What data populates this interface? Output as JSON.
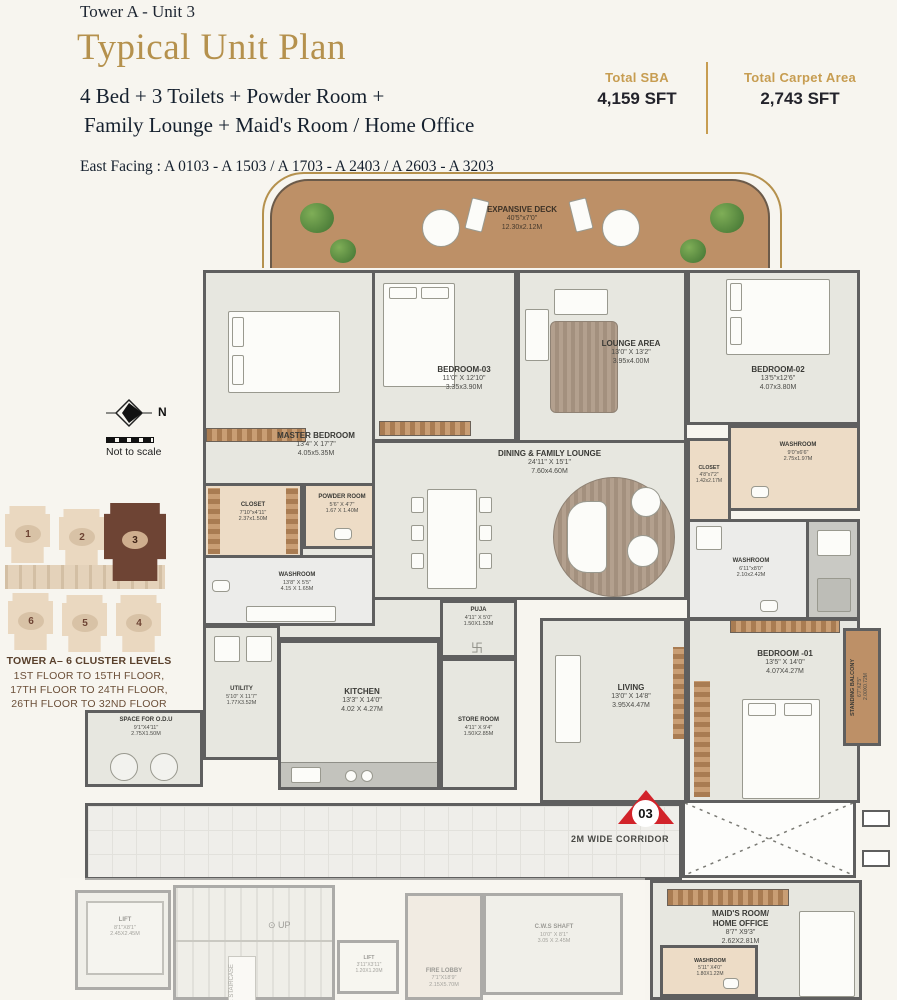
{
  "header": {
    "tower": "Tower A - Unit 3",
    "title": "Typical Unit Plan",
    "subtitle_line1": "4 Bed + 3 Toilets + Powder Room +",
    "subtitle_line2": "Family Lounge + Maid's Room / Home Office",
    "facing": "East Facing : A 0103  - A 1503 / A 1703 - A 2403 / A 2603 - A 3203",
    "stats": [
      {
        "label": "Total SBA",
        "value": "4,159 SFT"
      },
      {
        "label": "Total Carpet Area",
        "value": "2,743 SFT"
      }
    ]
  },
  "compass": {
    "north": "N",
    "note": "Not to scale"
  },
  "key_plan": {
    "title": "TOWER A– 6 CLUSTER LEVELS",
    "floors": [
      "1ST FLOOR TO 15TH FLOOR,",
      "17TH FLOOR TO 24TH FLOOR,",
      "26TH FLOOR TO 32ND FLOOR"
    ],
    "units": [
      "1",
      "2",
      "3",
      "6",
      "5",
      "4"
    ],
    "highlighted_unit": "3"
  },
  "plan": {
    "marker": "03",
    "corridor": "2M WIDE CORRIDOR",
    "rooms": {
      "deck": {
        "name": "EXPANSIVE DECK",
        "l1": "40'5\"x7'0\"",
        "l2": "12.30x2.12M"
      },
      "master": {
        "name": "MASTER BEDROOM",
        "l1": "13'4\" X 17'7\"",
        "l2": "4.05x5.35M"
      },
      "bed3": {
        "name": "BEDROOM-03",
        "l1": "11'0\" X 12'10\"",
        "l2": "3.35x3.90M"
      },
      "lounge": {
        "name": "LOUNGE AREA",
        "l1": "13'0\" X 13'2\"",
        "l2": "3.95x4.00M"
      },
      "bed2": {
        "name": "BEDROOM-02",
        "l1": "13'5\"x12'6\"",
        "l2": "4.07x3.80M"
      },
      "wash2": {
        "name": "WASHROOM",
        "l1": "9'0\"x6'6\"",
        "l2": "2.75x1.97M"
      },
      "closet2": {
        "name": "CLOSET",
        "l1": "4'8\"x7'2\"",
        "l2": "1.42x2.17M"
      },
      "wash3": {
        "name": "WASHROOM",
        "l1": "6'11\"x8'0\"",
        "l2": "2.10x2.42M"
      },
      "dining": {
        "name": "DINING & FAMILY LOUNGE",
        "l1": "24'11\" X 15'1\"",
        "l2": "7.60x4.60M"
      },
      "closet1": {
        "name": "CLOSET",
        "l1": "7'10\"x4'11\"",
        "l2": "2.37x1.50M"
      },
      "powder": {
        "name": "POWDER ROOM",
        "l1": "5'6\" X 4'7\"",
        "l2": "1.67 X 1.40M"
      },
      "wash1": {
        "name": "WASHROOM",
        "l1": "13'8\" X 5'5\"",
        "l2": "4.15 X 1.65M"
      },
      "puja": {
        "name": "PUJA",
        "l1": "4'11\" X 5'0\"",
        "l2": "1.50X1.52M"
      },
      "store": {
        "name": "STORE ROOM",
        "l1": "4'11\" X 9'4\"",
        "l2": "1.50X2.85M"
      },
      "kitchen": {
        "name": "KITCHEN",
        "l1": "13'3\" X 14'0\"",
        "l2": "4.02 X 4.27M"
      },
      "utility": {
        "name": "UTILITY",
        "l1": "5'10\" X 11'7\"",
        "l2": "1.77X3.52M"
      },
      "living": {
        "name": "LIVING",
        "l1": "13'0\" X 14'8\"",
        "l2": "3.95X4.47M"
      },
      "odu": {
        "name": "SPACE FOR O.D.U",
        "l1": "9'1\"X4'11\"",
        "l2": "2.75X1.50M"
      },
      "balcony": {
        "name": "STANDING BALCONY",
        "l1": "6'7\"X2'5\"",
        "l2": "2.00X0.72M"
      },
      "bed1": {
        "name": "BEDROOM -01",
        "l1": "13'5\" X 14'0\"",
        "l2": "4.07X4.27M"
      },
      "lift": {
        "name": "LIFT",
        "l1": "8'1\"X8'1\"",
        "l2": "2.45X2.45M"
      },
      "stairs": {
        "name": "UP"
      },
      "firestair": {
        "name": "FIRE STAIRCASE"
      },
      "lift2": {
        "name": "LIFT",
        "l1": "3'11\"X3'11\"",
        "l2": "1.20X1.20M"
      },
      "cws": {
        "name": "C.W.S SHAFT",
        "l1": "10'0\" X 8'1\"",
        "l2": "3.05 X 2.45M"
      },
      "firelobby": {
        "name": "FIRE LOBBY",
        "l1": "7'1\"X18'9\"",
        "l2": "2.15X5.70M"
      },
      "maid": {
        "name": "MAID'S ROOM/\nHOME OFFICE",
        "l1": "8'7\" X9'3\"",
        "l2": "2.62X2.81M"
      },
      "washmaid": {
        "name": "WASHROOM",
        "l1": "5'11\" X4'0\"",
        "l2": "1.80X1.22M"
      }
    }
  },
  "colors": {
    "accent_gold": "#b5914d",
    "wall": "#5f5f5f",
    "deck_wood": "#bd9067",
    "wet_beige": "#eddcc6",
    "marker_red": "#d2232a",
    "key_highlight_brown": "#6e4434"
  }
}
